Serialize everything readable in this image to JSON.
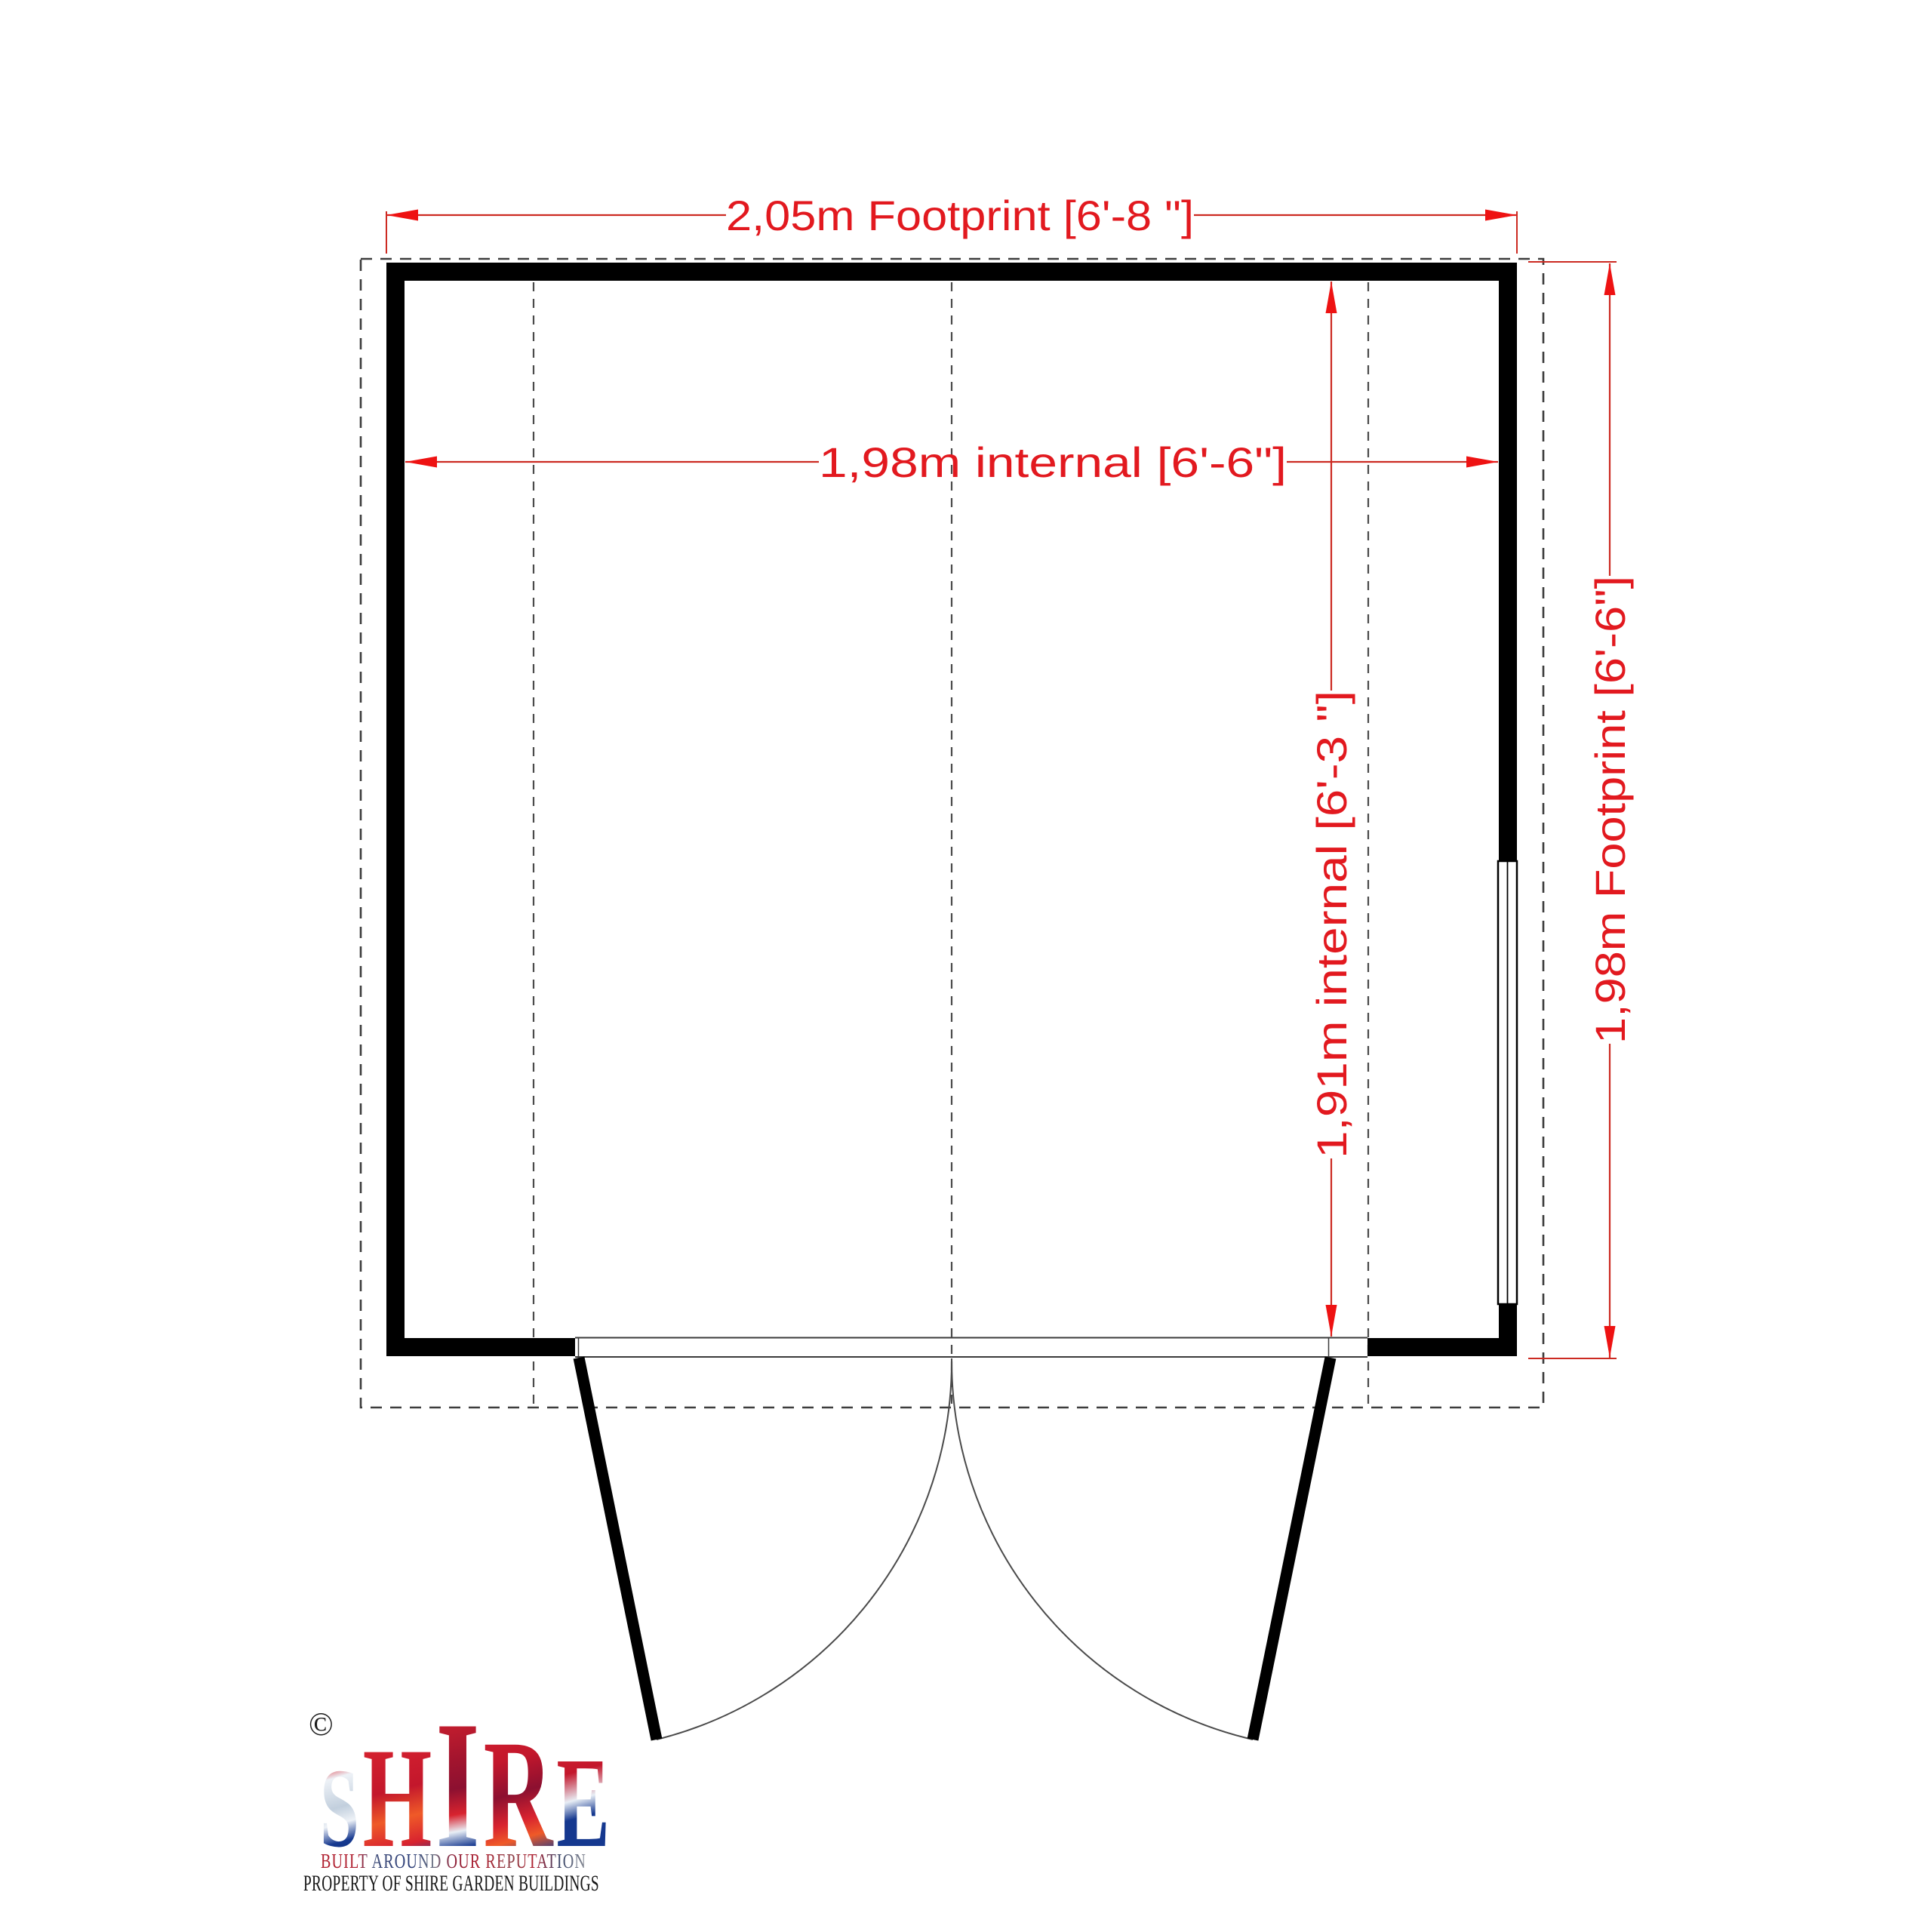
{
  "plan": {
    "dimensions": {
      "width_footprint": "2,05m Footprint [6'-8 \"]",
      "width_internal": "1,98m internal  [6'-6\"]",
      "depth_internal": "1,91m internal  [6'-3 \"]",
      "depth_footprint": "1,98m Footprint [6'-6\"]"
    },
    "colors": {
      "dimension_red": "#e2191f",
      "wall_black": "#000000",
      "overhang_dash_gray": "#3d3d3d"
    }
  },
  "logo": {
    "copyright": "©",
    "brand": "SHIRE",
    "brand_letters": [
      "S",
      "H",
      "I",
      "R",
      "E"
    ],
    "tagline": "BUILT AROUND OUR REPUTATION",
    "property_line": "PROPERTY OF SHIRE GARDEN BUILDINGS",
    "brand_colors": {
      "red": "#c8102e",
      "blue": "#012169",
      "silver": "#dfe7ef"
    }
  }
}
